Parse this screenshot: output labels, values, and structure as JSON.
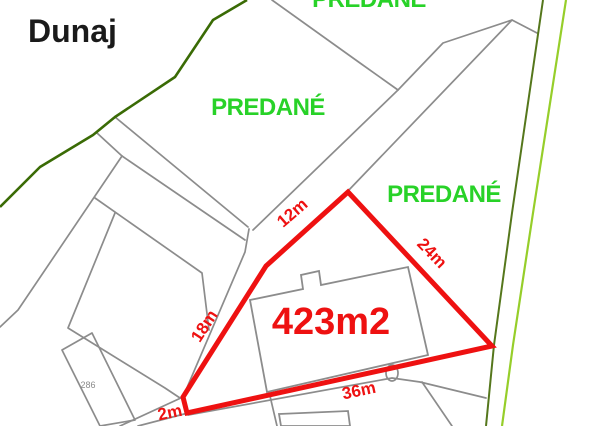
{
  "colors": {
    "highlight_red": "#ee1111",
    "sold_green": "#28d228",
    "boundary_dark_green": "#3a6b05",
    "boundary_olive": "#55771c",
    "boundary_light_green": "#96ce2a",
    "parcel_gray": "#8c8c8c",
    "title_black": "#1a1a1a",
    "parcel_number_gray": "#8a8a8a"
  },
  "labels": {
    "area_title": "Dunaj",
    "sold_top": "PREDANÉ",
    "sold_middle": "PREDANÉ",
    "sold_right": "PREDANÉ",
    "parcel_number": "286"
  },
  "highlighted_parcel": {
    "area": "423m2",
    "side_top": "12m",
    "side_right": "24m",
    "side_left": "18m",
    "side_bottom": "36m",
    "side_small": "2m"
  }
}
